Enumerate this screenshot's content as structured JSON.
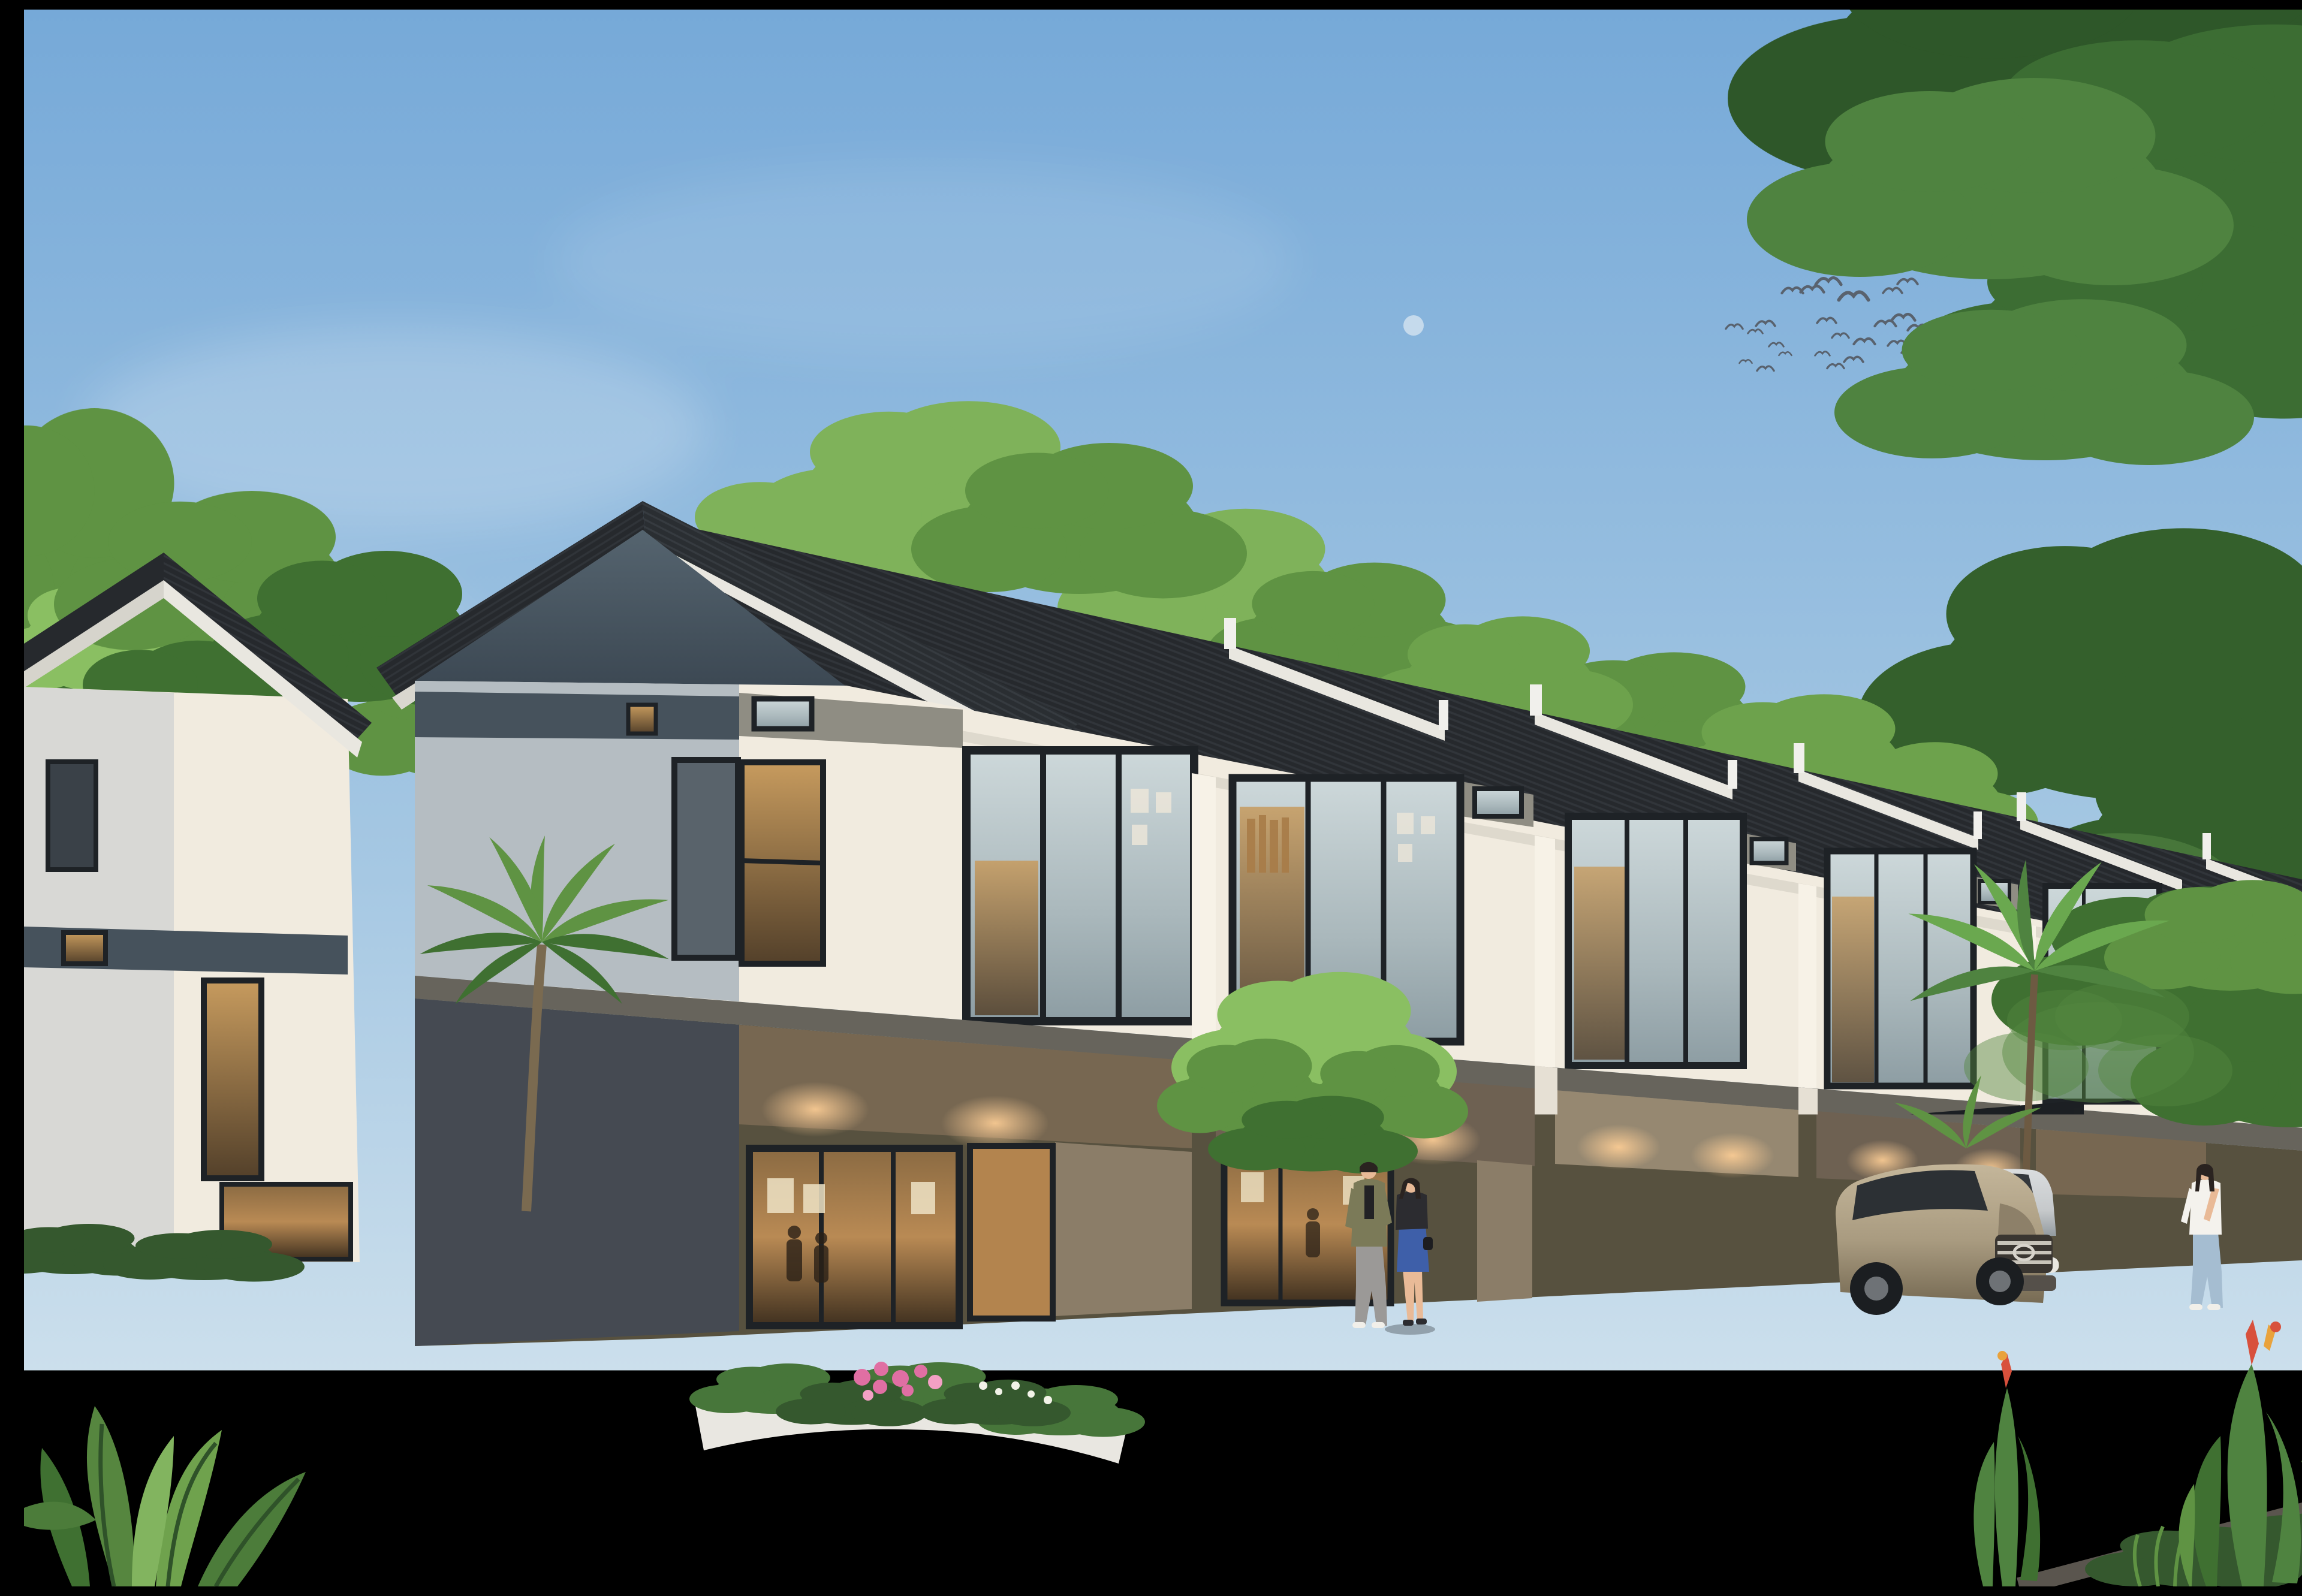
{
  "scene": {
    "kind": "exterior-architectural-rendering",
    "subject": "two-story-modern-townhouse-row-at-dusk",
    "objects": [
      "sky",
      "clouds",
      "moon",
      "bird-flock",
      "tree-canopies",
      "end-house",
      "townhouse-row",
      "sawtooth-roofs",
      "upper-floor-windows",
      "ground-floor-glass",
      "carports",
      "white-suv",
      "teal-crossover",
      "mint-kei-car",
      "tan-minivan",
      "silver-suv",
      "walking-women",
      "walking-couple",
      "family-with-child",
      "man-with-stroller",
      "flower-planters",
      "hedge-median",
      "palm-trees",
      "paved-forecourt",
      "asphalt-road",
      "foreground-plants"
    ]
  },
  "palette": {
    "sky_top": "#76a9d8",
    "sky_mid": "#a6c8e3",
    "sky_horizon": "#dce9f0",
    "cloud": "#ffffff",
    "moon": "#eef4f7",
    "bird": "#59626e",
    "roof_dark": "#26292d",
    "roof_rib": "#3c4147",
    "fascia": "#e9e7e0",
    "ridge_cap": "#f1f0ec",
    "gable_light": "#55646f",
    "gable_dark": "#3c4853",
    "wall_white": "#f1ebdf",
    "wall_shade": "#b0b9bf",
    "band_slate": "#46525c",
    "band_greige": "#8f8d83",
    "frame": "#1e2226",
    "glass_sky": "#c2ced1",
    "glass_warm": "#b98a54",
    "slab": "#67645c",
    "soffit": "#d3ccbd",
    "panel_brown": "#776751",
    "panel_taupe": "#968871",
    "panel_gray": "#6e6a5f",
    "door_wood": "#b3844e",
    "column": "#e6e0d4",
    "glow": "#ffcf96",
    "green_bright": "#8abf62",
    "green_mid": "#5f9343",
    "green_dark": "#3f7031",
    "green_deep": "#2e5729",
    "hedge": "#35582e",
    "trunk": "#6d5138",
    "flower_pink": "#e06fa3",
    "flower_white": "#f2f2e8",
    "flower_red": "#d8503c",
    "tile": "#c9bda3",
    "tile_line": "#b2a68c",
    "asphalt": "#4d555e",
    "asphalt_warm": "#6e6963",
    "curb": "#e9e7e1",
    "curb_stone": "#5a554e",
    "vine_wall": "#d2d4c9",
    "suv_white": "#eef1f3",
    "car_teal": "#8fb8b0",
    "car_teal_dark": "#5d837c",
    "kei_mint": "#bdd4c5",
    "van_tan": "#a99b80",
    "suv_silver": "#c6c9cb",
    "wheel": "#1b1e21",
    "alloy": "#c8cbcd",
    "skin": "#e9ba97",
    "hair": "#2a2320",
    "shirt_white": "#f4f2ed",
    "shirt_cream": "#ebe2cf",
    "shirt_striped": "#e6ddc8",
    "pants_khaki": "#a98f66",
    "denim": "#5d7fae",
    "denim_light": "#a5bdd1",
    "jacket_olive": "#7b7a58",
    "pants_gray": "#9b9997",
    "dress_blue": "#3e5fa9",
    "jacket_black": "#2c2c30",
    "stroller": "#3a3f44"
  },
  "birds": [
    [
      2853,
      530,
      0.8
    ],
    [
      2888,
      538,
      0.7
    ],
    [
      2905,
      525,
      0.9
    ],
    [
      2923,
      560,
      0.7
    ],
    [
      2938,
      575,
      0.6
    ],
    [
      2905,
      600,
      0.8
    ],
    [
      2872,
      588,
      0.6
    ],
    [
      2950,
      470,
      1.0
    ],
    [
      2983,
      468,
      1.1
    ],
    [
      3010,
      455,
      1.2
    ],
    [
      3052,
      480,
      1.4
    ],
    [
      3007,
      520,
      0.9
    ],
    [
      3030,
      545,
      0.8
    ],
    [
      3070,
      555,
      1.0
    ],
    [
      3052,
      585,
      0.9
    ],
    [
      3022,
      596,
      0.8
    ],
    [
      3000,
      575,
      0.7
    ],
    [
      3105,
      525,
      1.0
    ],
    [
      3135,
      515,
      1.1
    ],
    [
      3160,
      532,
      1.0
    ],
    [
      3125,
      558,
      0.9
    ],
    [
      3147,
      570,
      0.85
    ],
    [
      3117,
      470,
      0.9
    ],
    [
      3142,
      455,
      0.95
    ]
  ],
  "vehicles": [
    {
      "name": "white-suv",
      "color": "suv_white",
      "location": "left-road"
    },
    {
      "name": "teal-crossover",
      "color": "car_teal",
      "location": "center-forecourt"
    },
    {
      "name": "mint-kei-car",
      "color": "kei_mint",
      "location": "carport-1"
    },
    {
      "name": "tan-minivan",
      "color": "van_tan",
      "location": "carport-2"
    },
    {
      "name": "silver-suv",
      "color": "suv_silver",
      "location": "far-right"
    }
  ],
  "people": [
    {
      "name": "woman-striped",
      "location": "beside-teal-car"
    },
    {
      "name": "woman-cream",
      "location": "beside-teal-car"
    },
    {
      "name": "man-olive-jacket",
      "location": "center-walkway"
    },
    {
      "name": "woman-blue-dress",
      "location": "center-walkway"
    },
    {
      "name": "man-with-stroller",
      "location": "right-walkway"
    },
    {
      "name": "father-pointing",
      "location": "right-foreground"
    },
    {
      "name": "child",
      "location": "right-foreground"
    },
    {
      "name": "mother",
      "location": "right-foreground"
    }
  ]
}
